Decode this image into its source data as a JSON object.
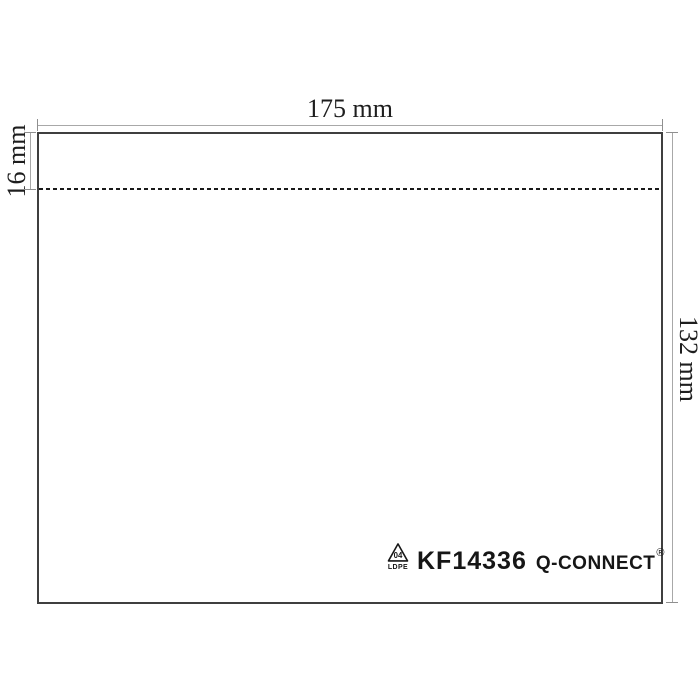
{
  "diagram": {
    "dimensions": {
      "width": {
        "label": "175 mm",
        "value_mm": 175
      },
      "flap": {
        "label": "16 mm",
        "value_mm": 16
      },
      "height": {
        "label": "132 mm",
        "value_mm": 132
      }
    },
    "branding": {
      "sku": "KF14336",
      "brand": "Q-CONNECT",
      "registered": "®",
      "recycling_code": "04",
      "material": "LDPE"
    },
    "colors": {
      "background": "#ffffff",
      "outline": "#3f3f3f",
      "dimension_line": "#a8a8a8",
      "dimension_tick": "#8f8f8f",
      "fold_line": "#1a1a1a",
      "label_text": "#1e1e1e",
      "brand_text": "#161616"
    }
  }
}
